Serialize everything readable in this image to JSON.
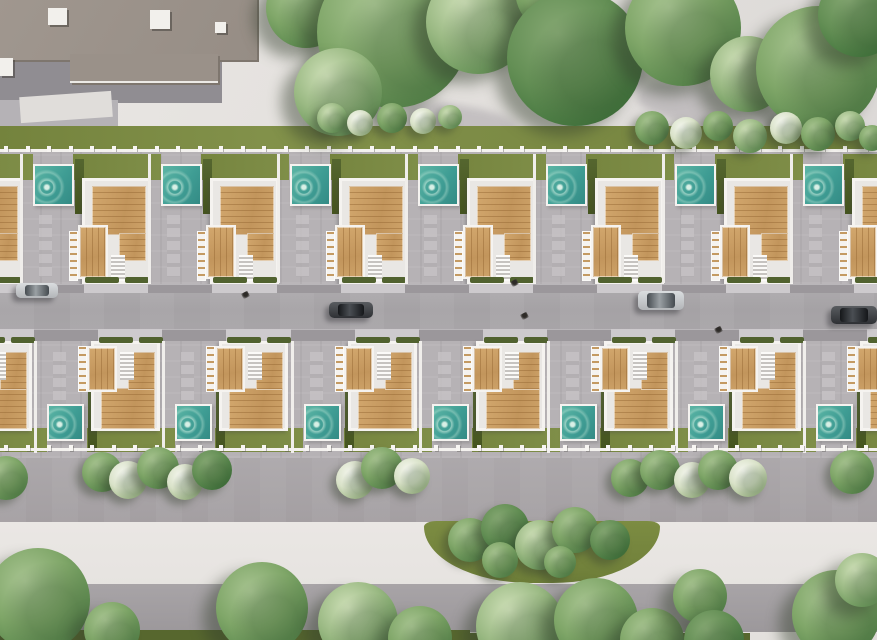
{
  "scene": {
    "kind": "aerial-3d-render",
    "subject": "two rows of white villas with rooftop wood decks and private pools along a central street, parkland above and below"
  },
  "palette": {
    "pavement": "#e7e4e1",
    "sidewalk": "#cdcacd",
    "apron": "#9b979b",
    "driveway": "#b6b2b5",
    "white": "#f5f3f0",
    "inner": "#e9e7e4",
    "bottomGrass": "#57672e",
    "poolTeal": "#3f9d94",
    "wood": "#c99e66",
    "grass": "#7b8a43",
    "hedge": "#4c5c2b",
    "road": "#a9a6a9"
  },
  "geometry": {
    "canvas": {
      "w": 877,
      "h": 640
    },
    "grass_strip": [
      0,
      126,
      877,
      26
    ],
    "fence_top": {
      "y": 149,
      "post_y": 146,
      "step": 21.5,
      "count": 41
    },
    "fence_bottom": {
      "y": 448,
      "post_y": 445,
      "step": 21.5,
      "count": 41
    },
    "row_top": {
      "band": [
        0,
        152,
        877,
        132
      ],
      "units_x": [
        -95,
        33,
        161,
        290,
        418,
        546,
        675,
        803
      ],
      "unit": {
        "grass": [
          40,
          154,
          88,
          26
        ],
        "pool": [
          0,
          164,
          41,
          42
        ],
        "hedge": [
          42,
          159,
          9,
          55
        ],
        "house": [
          49,
          178,
          69,
          106
        ],
        "big_deck": [
          7,
          5,
          54,
          49
        ],
        "deck_col": [
          34,
          52,
          27,
          28
        ],
        "small_deck": [
          -7,
          44,
          30,
          54
        ],
        "ladder": [
          -16,
          50,
          9,
          50
        ],
        "stairs": [
          26,
          74,
          14,
          26
        ],
        "pavers": [
          6,
          215,
          13,
          62
        ],
        "front_hedges": [
          [
            52,
            277,
            34,
            6
          ],
          [
            92,
            277,
            24,
            6
          ]
        ],
        "divider_y": [
          154,
          129
        ]
      }
    },
    "road": {
      "band": [
        0,
        284,
        877,
        57
      ],
      "sidewalk_n": [
        0,
        284,
        877,
        9
      ],
      "sidewalk_s": [
        0,
        329,
        877,
        12
      ],
      "apron_w": 64
    },
    "row_bottom": {
      "band": [
        0,
        341,
        877,
        117
      ],
      "units_x": [
        -81,
        47,
        175,
        304,
        432,
        560,
        688,
        816
      ],
      "unit": {
        "grass": [
          40,
          428,
          88,
          24
        ],
        "pool": [
          0,
          404,
          37,
          37
        ],
        "hedge": [
          41,
          390,
          9,
          60
        ],
        "house": [
          44,
          341,
          69,
          90
        ],
        "big_deck": [
          7,
          44,
          54,
          41
        ],
        "deck_col": [
          34,
          8,
          27,
          38
        ],
        "small_deck": [
          -7,
          2,
          30,
          46
        ],
        "ladder": [
          -16,
          2,
          9,
          46
        ],
        "stairs": [
          26,
          8,
          14,
          28
        ],
        "pavers": [
          6,
          352,
          13,
          55
        ],
        "front_hedges": [
          [
            52,
            337,
            34,
            6
          ],
          [
            92,
            337,
            24,
            6
          ]
        ],
        "divider_y": [
          341,
          112
        ]
      }
    },
    "walkway": [
      0,
      458,
      877,
      64
    ],
    "pavement_bottom": [
      0,
      522,
      877,
      118
    ],
    "gray_band": [
      55,
      584,
      822,
      48
    ],
    "grass_bottom": [
      [
        0,
        630,
        470,
        10
      ],
      [
        430,
        633,
        320,
        7
      ]
    ],
    "green_bed": [
      424,
      521,
      236,
      62
    ],
    "bldg_left": {
      "roof": [
        -6,
        -4,
        260,
        61
      ],
      "ext": [
        70,
        54,
        148,
        27
      ],
      "terrace": [
        0,
        55,
        222,
        48
      ],
      "terrace_light": [
        0,
        100,
        118,
        28
      ],
      "white_patch": [
        20,
        94,
        92,
        26
      ],
      "roof_units": [
        [
          48,
          8,
          19,
          17
        ],
        [
          150,
          10,
          20,
          19
        ],
        [
          215,
          22,
          11,
          11
        ],
        [
          0,
          58,
          13,
          18
        ]
      ]
    },
    "bldg_right": {
      "roof": [
        652,
        -6,
        76,
        22
      ],
      "shadow": [
        590,
        12,
        140,
        30
      ]
    },
    "plaza_shadows": [
      [
        500,
        28,
        150,
        46,
        24
      ],
      [
        636,
        92,
        175,
        40,
        12
      ],
      [
        406,
        106,
        112,
        34,
        10
      ]
    ]
  },
  "vegetation": {
    "trees_top": [
      {
        "x": 306,
        "y": 8,
        "r": 40,
        "tone": "mid"
      },
      {
        "x": 393,
        "y": 32,
        "r": 76,
        "tone": "mid"
      },
      {
        "x": 338,
        "y": 92,
        "r": 44,
        "tone": "light"
      },
      {
        "x": 478,
        "y": 22,
        "r": 52,
        "tone": "light"
      },
      {
        "x": 560,
        "y": -10,
        "r": 45,
        "tone": "mid"
      },
      {
        "x": 575,
        "y": 58,
        "r": 68,
        "tone": "dark"
      },
      {
        "x": 683,
        "y": 28,
        "r": 58,
        "tone": "mid"
      },
      {
        "x": 748,
        "y": 74,
        "r": 38,
        "tone": "light"
      },
      {
        "x": 818,
        "y": 68,
        "r": 62,
        "tone": "mid"
      },
      {
        "x": 860,
        "y": 15,
        "r": 42,
        "tone": "dark"
      }
    ],
    "bushes_top": [
      {
        "x": 332,
        "y": 118,
        "r": 15,
        "tone": "light"
      },
      {
        "x": 360,
        "y": 123,
        "r": 13,
        "tone": "flower"
      },
      {
        "x": 392,
        "y": 118,
        "r": 15,
        "tone": "mid"
      },
      {
        "x": 423,
        "y": 121,
        "r": 13,
        "tone": "flower"
      },
      {
        "x": 450,
        "y": 117,
        "r": 12,
        "tone": "light"
      },
      {
        "x": 652,
        "y": 128,
        "r": 17,
        "tone": "mid"
      },
      {
        "x": 686,
        "y": 133,
        "r": 16,
        "tone": "flower"
      },
      {
        "x": 718,
        "y": 126,
        "r": 15,
        "tone": "mid"
      },
      {
        "x": 750,
        "y": 136,
        "r": 17,
        "tone": "light"
      },
      {
        "x": 786,
        "y": 128,
        "r": 16,
        "tone": "flower"
      },
      {
        "x": 818,
        "y": 134,
        "r": 17,
        "tone": "mid"
      },
      {
        "x": 850,
        "y": 126,
        "r": 15,
        "tone": "light"
      },
      {
        "x": 872,
        "y": 138,
        "r": 13,
        "tone": "mid"
      }
    ],
    "walkway_bushes": [
      {
        "x": 6,
        "y": 478,
        "r": 22,
        "tone": "mid"
      },
      {
        "x": 102,
        "y": 472,
        "r": 20,
        "tone": "mid"
      },
      {
        "x": 128,
        "y": 480,
        "r": 19,
        "tone": "flower"
      },
      {
        "x": 158,
        "y": 468,
        "r": 21,
        "tone": "mid"
      },
      {
        "x": 185,
        "y": 482,
        "r": 18,
        "tone": "flower"
      },
      {
        "x": 212,
        "y": 470,
        "r": 20,
        "tone": "dark"
      },
      {
        "x": 355,
        "y": 480,
        "r": 19,
        "tone": "flower"
      },
      {
        "x": 382,
        "y": 468,
        "r": 21,
        "tone": "mid"
      },
      {
        "x": 412,
        "y": 476,
        "r": 18,
        "tone": "flower"
      },
      {
        "x": 630,
        "y": 478,
        "r": 19,
        "tone": "mid"
      },
      {
        "x": 660,
        "y": 470,
        "r": 20,
        "tone": "mid"
      },
      {
        "x": 692,
        "y": 480,
        "r": 18,
        "tone": "flower"
      },
      {
        "x": 718,
        "y": 470,
        "r": 20,
        "tone": "mid"
      },
      {
        "x": 748,
        "y": 478,
        "r": 19,
        "tone": "flower"
      },
      {
        "x": 852,
        "y": 472,
        "r": 22,
        "tone": "mid"
      }
    ],
    "bed_bushes": [
      {
        "x": 470,
        "y": 540,
        "r": 22,
        "tone": "mid"
      },
      {
        "x": 505,
        "y": 528,
        "r": 24,
        "tone": "dark"
      },
      {
        "x": 540,
        "y": 545,
        "r": 25,
        "tone": "light"
      },
      {
        "x": 575,
        "y": 530,
        "r": 23,
        "tone": "mid"
      },
      {
        "x": 610,
        "y": 540,
        "r": 20,
        "tone": "dark"
      },
      {
        "x": 500,
        "y": 560,
        "r": 18,
        "tone": "mid"
      },
      {
        "x": 560,
        "y": 562,
        "r": 16,
        "tone": "mid"
      }
    ],
    "trees_bottom": [
      {
        "x": 38,
        "y": 600,
        "r": 52,
        "tone": "mid"
      },
      {
        "x": 112,
        "y": 630,
        "r": 28,
        "tone": "mid"
      },
      {
        "x": 262,
        "y": 608,
        "r": 46,
        "tone": "mid"
      },
      {
        "x": 358,
        "y": 622,
        "r": 40,
        "tone": "light"
      },
      {
        "x": 420,
        "y": 638,
        "r": 32,
        "tone": "mid"
      },
      {
        "x": 520,
        "y": 626,
        "r": 44,
        "tone": "light"
      },
      {
        "x": 596,
        "y": 620,
        "r": 42,
        "tone": "mid"
      },
      {
        "x": 652,
        "y": 640,
        "r": 32,
        "tone": "mid"
      },
      {
        "x": 700,
        "y": 596,
        "r": 27,
        "tone": "mid"
      },
      {
        "x": 714,
        "y": 640,
        "r": 30,
        "tone": "dark"
      },
      {
        "x": 836,
        "y": 614,
        "r": 44,
        "tone": "mid"
      },
      {
        "x": 862,
        "y": 580,
        "r": 27,
        "tone": "light"
      }
    ]
  },
  "traffic": {
    "cars": [
      {
        "x": 16,
        "y": 283,
        "w": 42,
        "h": 15,
        "tone": "silver"
      },
      {
        "x": 329,
        "y": 302,
        "w": 44,
        "h": 16,
        "tone": "dark"
      },
      {
        "x": 638,
        "y": 291,
        "w": 46,
        "h": 19,
        "tone": "silver"
      },
      {
        "x": 831,
        "y": 306,
        "w": 46,
        "h": 18,
        "tone": "dark"
      }
    ],
    "pedestrians": [
      {
        "x": 242,
        "y": 292
      },
      {
        "x": 511,
        "y": 280
      },
      {
        "x": 521,
        "y": 313
      },
      {
        "x": 715,
        "y": 327
      }
    ]
  }
}
